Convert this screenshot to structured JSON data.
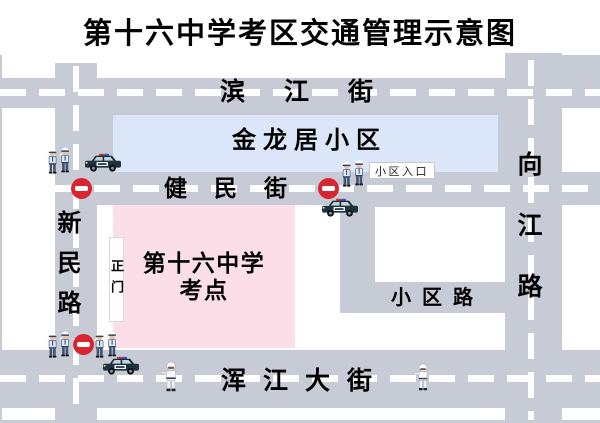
{
  "title": "第十六中学考区交通管理示意图",
  "roads": {
    "binjiang_street": "滨江街",
    "jianmin_street": "健民街",
    "hunjiang_avenue": "浑江大街",
    "xinmin_road": "新民路",
    "xiangjiang_road": "向江路",
    "xiaoqu_road": "小区路"
  },
  "areas": {
    "residential": "金龙居小区",
    "exam_site_line1": "第十六中学",
    "exam_site_line2": "考点",
    "main_gate": "正门",
    "entrance_label": "小区入口"
  },
  "colors": {
    "road_gray": "#c7cbd5",
    "residential_blue": "#dbe7f9",
    "exam_pink": "#fcdee9",
    "no_entry_red": "#d9252f",
    "dash_white": "#ffffff",
    "text_black": "#000000"
  },
  "icons": {
    "police_officers": "police-officers-pair",
    "police_car": "police-car",
    "no_entry": "no-entry-sign",
    "traffic_officer": "traffic-officer"
  }
}
